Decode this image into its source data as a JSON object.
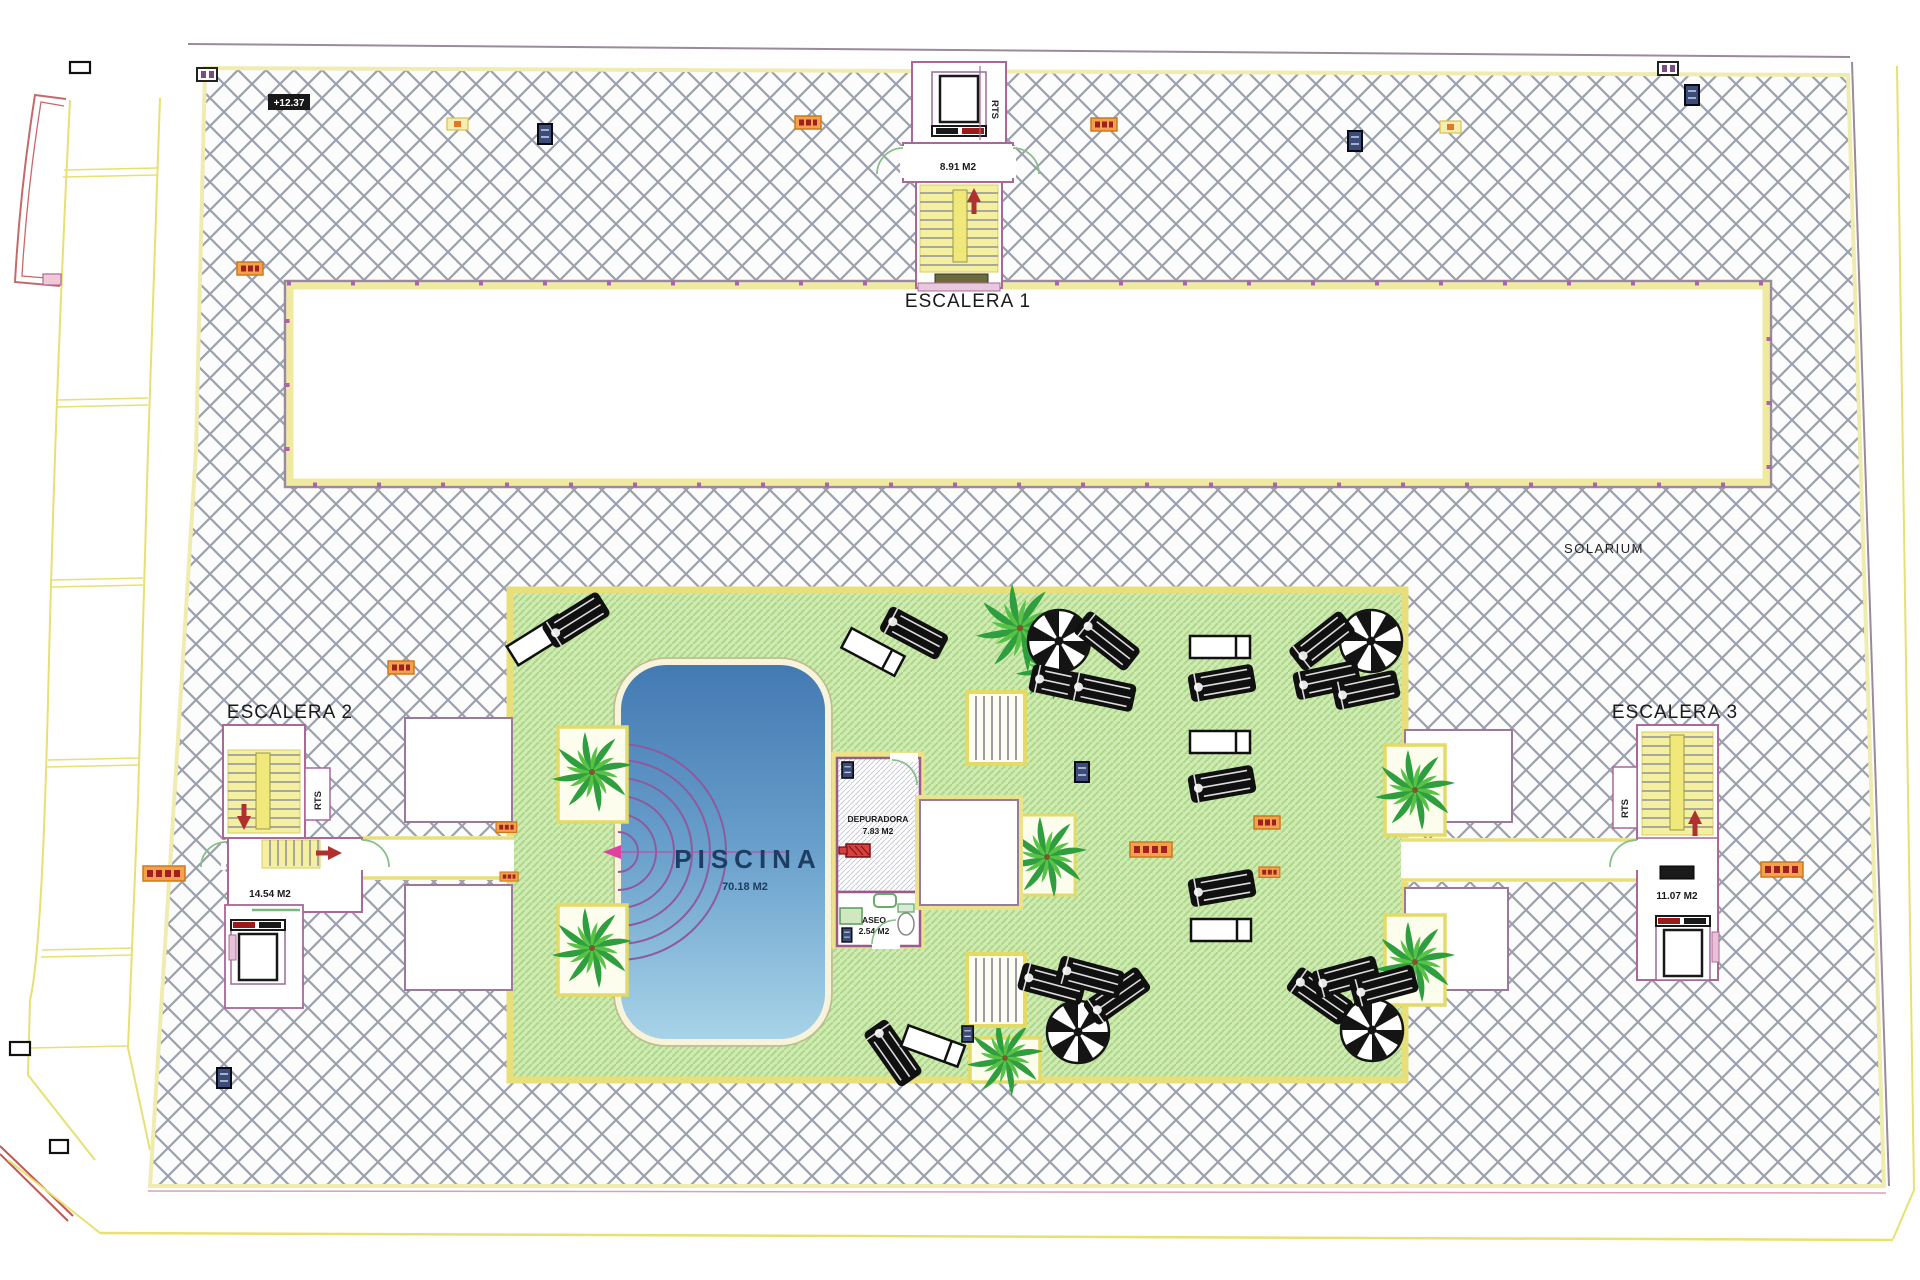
{
  "plan": {
    "solarium_label": "SOLARIUM",
    "level_marker": "+12.37"
  },
  "stairs": {
    "escalera1": {
      "label": "ESCALERA 1",
      "area": "8.91 M2",
      "shaft": "RTS"
    },
    "escalera2": {
      "label": "ESCALERA 2",
      "area": "14.54 M2",
      "shaft": "RTS"
    },
    "escalera3": {
      "label": "ESCALERA 3",
      "area": "11.07 M2",
      "shaft": "RTS"
    }
  },
  "pool": {
    "label": "PISCINA",
    "area": "70.18 M2"
  },
  "rooms": {
    "depuradora": {
      "label": "DEPURADORA",
      "area": "7.83 M2"
    },
    "aseo": {
      "label": "ASEO",
      "area": "2.54 M2"
    }
  },
  "colors": {
    "hatch_line": "#9aa0ac",
    "deck_green": "#cfeab2",
    "deck_stripe": "#aad685",
    "pool_top": "#4279b2",
    "pool_bottom": "#a8d4e8",
    "border_yellow": "#e9df7a",
    "wall_purple": "#a86898",
    "stair_yellow": "#f5f0a0",
    "arrow_red": "#b03030",
    "annotation_orange": "#f2a24e",
    "annotation_blue": "#3c4c78",
    "pool_steps_purple": "#8e5a9e"
  }
}
